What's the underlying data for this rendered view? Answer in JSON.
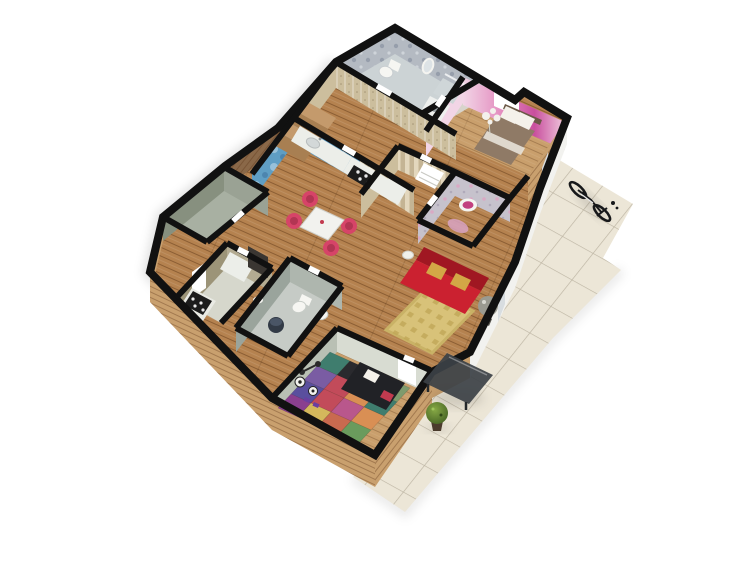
{
  "scene": {
    "type": "isometric-3d-floor-plan-render",
    "background": "#ffffff"
  },
  "colors": {
    "wall_top": "#111111",
    "wood_exterior": "#c9a06e",
    "wood_exterior_dark": "#8a6848",
    "tile_floor": "#ece6d7",
    "tile_grid": "#bcb4a2",
    "wood_floor": "#b5824f",
    "wood_floor_light": "#c99f6c",
    "bath_wall": "#b4bac2",
    "bath_floor": "#ccd3d5",
    "divider_gray": "#d8d4cc",
    "bedroom_wall": "#e07fb8",
    "bedroom_wall_light": "#f2d5e6",
    "bed_headboard": "#6b5846",
    "bed_duvet": "#8f7a66",
    "pillow_white": "#f4f1ea",
    "flower_white": "#f3f1ec",
    "kitchen_wall": "#5f9ec4",
    "hall_wall": "#ccbe9d",
    "stripe_wall": "#d9cbab",
    "vanity_wall": "#c6c2cc",
    "vanity_accent": "#c2407f",
    "vanity_rug": "#d8a3c2",
    "gray_wall": "#9aa294",
    "gray_wall_dark": "#87907f",
    "gray_floor": "#a8b0a2",
    "utility_wall": "#b3ab92",
    "utility_wall_dark": "#9c9478",
    "utility_floor": "#d6d7cc",
    "bath2_wall": "#aeb6ae",
    "bath2_wall_dark": "#9aa49c",
    "bath2_floor": "#c6cbc6",
    "kids_wall_n": "#d8dcd2",
    "kids_wall_w": "#b9c0b4",
    "se_wall_white": "#f2f2ef",
    "window_inset": "#d8dde0",
    "door_white": "#ffffff",
    "counter_white": "#eceee9",
    "cooktop_black": "#1c1c1c",
    "stove_white": "#e9eae4",
    "cabinet_dark": "#3a3632",
    "toilet_white": "#f6f6f2",
    "pedestal_navy": "#323a46",
    "mirror_white": "#f4f4f0",
    "table_white": "#f2f2ee",
    "chair_pink": "#d64468",
    "chair_pink_dark": "#b23553",
    "sofa_red": "#cb2130",
    "sofa_red_dark": "#a01722",
    "cushion_gold": "#d3a746",
    "rug_gold": "#d8c279",
    "rug_motif": "#c0a757",
    "washer_white": "#eef0ee",
    "futon_black": "#212226",
    "glass_dark": "#3c4146",
    "topiary_green": "#5d7a33",
    "pot_brown": "#4a3a2c",
    "bike_black": "#17181a",
    "shadow": "rgba(0,0,0,0.12)"
  },
  "rooms": [
    {
      "id": "bathroom-main",
      "finish": "gray damask tile"
    },
    {
      "id": "bedroom",
      "finish": "pink watercolor wallpaper"
    },
    {
      "id": "hallway",
      "finish": "tan travertine"
    },
    {
      "id": "kitchen",
      "finish": "blue mottled plaster"
    },
    {
      "id": "living-room",
      "finish": "striped wallpaper"
    },
    {
      "id": "vanity-room",
      "finish": "lavender floral"
    },
    {
      "id": "wardrobe-hall",
      "finish": "tan stripes"
    },
    {
      "id": "storage-room",
      "finish": "bare concrete"
    },
    {
      "id": "utility-kitchen",
      "finish": "olive plaster"
    },
    {
      "id": "bathroom-small",
      "finish": "gray tile"
    },
    {
      "id": "kids-room",
      "finish": "pale green"
    }
  ],
  "objects": [
    "toilet",
    "wall-mirror",
    "shower-tray",
    "washing-machine",
    "double-bed",
    "pillows",
    "white-flower-decor",
    "window",
    "kitchen-counter",
    "sink",
    "cooktop",
    "fridge",
    "dining-table",
    "dining-chairs-x4",
    "staircase",
    "wardrobe",
    "sofa",
    "gold-cushions",
    "area-rug",
    "side-table",
    "decor-plant",
    "stove",
    "cabinets",
    "toilet-2",
    "bidet",
    "pedestal-sink",
    "play-mat",
    "futon",
    "soccer-balls",
    "barbell",
    "dumbbells",
    "glass-table",
    "topiary-plant",
    "bicycle",
    "tiled-terrace"
  ],
  "kids_room": {
    "mat_colors": [
      "#3f7d6e",
      "#2a2a2e",
      "#232327",
      "#7e9b6d",
      "#7a5ca3",
      "#c24b5a",
      "#d98f54",
      "#3f7d6e",
      "#5a4f9e",
      "#c24b5a",
      "#b9578c",
      "#d98f54",
      "#8a3f8f",
      "#d4b85c",
      "#c96a4f",
      "#6a9b5d"
    ]
  }
}
